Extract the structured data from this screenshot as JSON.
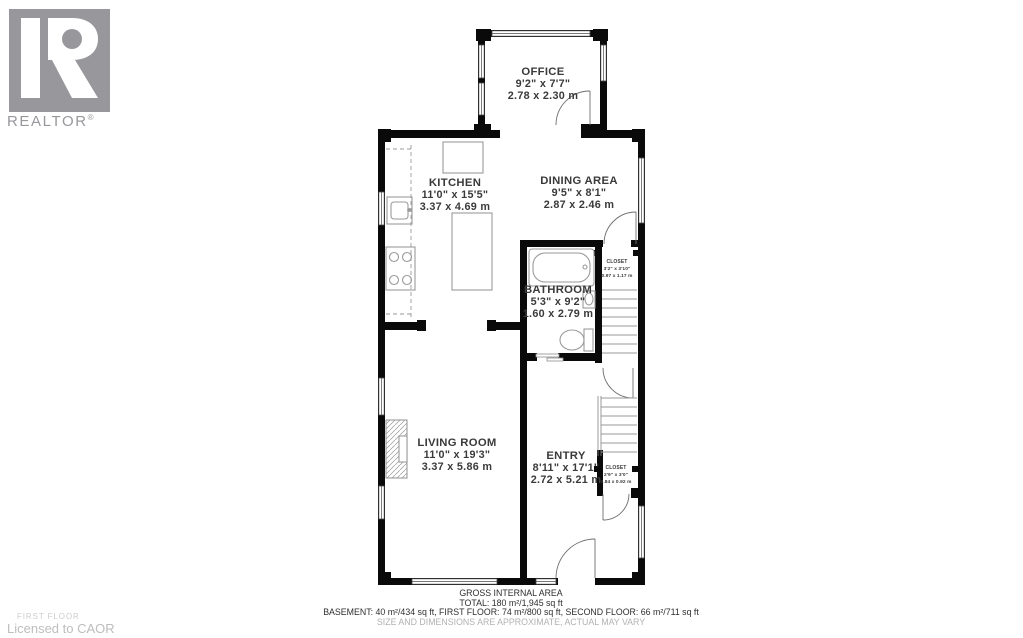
{
  "branding": {
    "logo_text": "REALTOR",
    "registered_mark": "®",
    "logo_color": "#98979c"
  },
  "rooms": {
    "office": {
      "name": "OFFICE",
      "imperial": "9'2\" x 7'7\"",
      "metric": "2.78 x 2.30 m"
    },
    "kitchen": {
      "name": "KITCHEN",
      "imperial": "11'0\" x 15'5\"",
      "metric": "3.37 x 4.69 m"
    },
    "dining": {
      "name": "DINING AREA",
      "imperial": "9'5\" x 8'1\"",
      "metric": "2.87 x 2.46 m"
    },
    "bathroom": {
      "name": "BATHROOM",
      "imperial": "5'3\" x 9'2\"",
      "metric": "1.60 x 2.79 m"
    },
    "closet_upper": {
      "name": "CLOSET",
      "imperial": "3'2\" x 3'10\"",
      "metric": "0.97 x 1.17 m"
    },
    "living": {
      "name": "LIVING ROOM",
      "imperial": "11'0\" x 19'3\"",
      "metric": "3.37 x 5.86 m"
    },
    "entry": {
      "name": "ENTRY",
      "imperial": "8'11\" x 17'1\"",
      "metric": "2.72 x 5.21 m"
    },
    "closet_lower": {
      "name": "CLOSET",
      "imperial": "2'9\" x 3'0\"",
      "metric": "0.84 x 0.92 m"
    }
  },
  "footer": {
    "title": "GROSS INTERNAL AREA",
    "total": "TOTAL: 180 m²/1,945 sq ft",
    "breakdown": "BASEMENT: 40 m²/434 sq ft, FIRST FLOOR: 74 m²/800 sq ft, SECOND FLOOR: 66 m²/711 sq ft",
    "disclaimer": "SIZE AND DIMENSIONS ARE APPROXIMATE, ACTUAL MAY VARY"
  },
  "floor_label": {
    "floor": "FIRST FLOOR",
    "licensed": "Licensed to CAOR"
  }
}
